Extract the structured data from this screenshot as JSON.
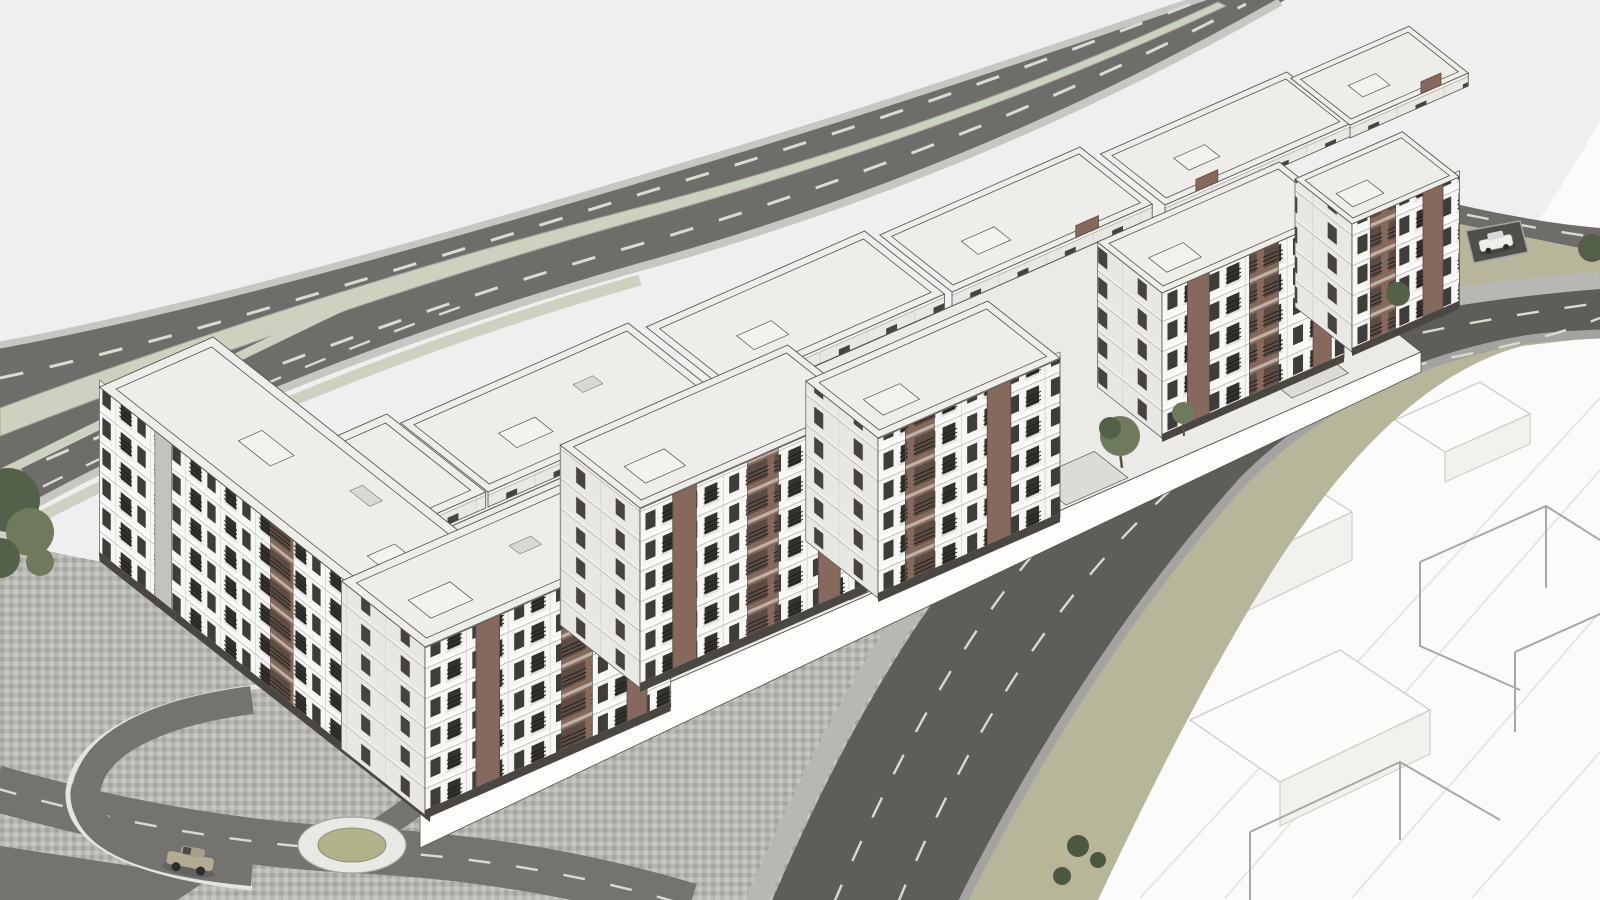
{
  "meta": {
    "title": "Aerial 3D architectural massing render of a residential apartment complex",
    "style": "monochrome SketchUp-style visualization, no text or UI elements visible",
    "canvas": {
      "width": 1600,
      "height": 900
    }
  },
  "colors": {
    "sky": "#f0eff0",
    "ghost": "#fbfbfa",
    "seam": "#e6e6e3",
    "wireframe": "#a8a8a5",
    "ghostBoxTop": "#fcfcfb",
    "ghostBoxSide": "#f1f1ee",
    "ghostBoxEdge": "#cfcfcc",
    "asphaltHighway": "#6e6d69",
    "asphaltMain": "#5e5d5a",
    "rampRoad": "#747370",
    "laneMarking": "#dadad2",
    "medianSage": "#ccd1c0",
    "vergeKhaki": "#b7b69b",
    "cobbleLight": "#c6c6c2",
    "cobbleMid": "#b7b7b3",
    "cobbleDark": "#a3a39f",
    "parkingBay": "#4f4e4b",
    "wallLight": "#e5e4e1",
    "facadeWhite": "#f7f6f3",
    "facadeSeam": "#cfcdc8",
    "facadeShade": "#e8e7e3",
    "facadeShadeSlab": "#f1efec",
    "stringCourse": "#9b9894",
    "cornice": "#fdfdfb",
    "plinth": "#4a4742",
    "roofLight": "#eeede9",
    "podium": "#ebeae7",
    "courtyard": "#dcdbd6",
    "bulkhead": "#f3f2ef",
    "vent": "#d9d8d4",
    "edgeInk": "#56524d",
    "windowDark": "#3f3d39",
    "windowDeep": "#34322e",
    "windowShade": "#47443f",
    "railing": "#1d1c19",
    "balcSlab": "#e4e2de",
    "accentBrown": "#84695c",
    "accentBrownDark": "#5d4c43",
    "accentBrownLight": "#c0b1a6",
    "grayAccent": "#c3c2be",
    "ringWhite": "#e9e8e5",
    "roundCenter": "#b1b18a",
    "roundCenterEdge": "#8f8f74",
    "treeDark": "#55604a",
    "treeMid": "#6e7a5b",
    "shrub": "#4c5640",
    "carBeige": "#b3ab94",
    "carBeigeTop": "#a79f8a",
    "carWhite": "#ededeb",
    "carWhiteTop": "#d6d8d8",
    "carGlass": "#4a4a46",
    "carEdge": "#6f6a5e",
    "wheel": "#2e2d2a"
  },
  "scene": {
    "background": "plain light-gray backdrop",
    "objects": [
      {
        "name": "highway",
        "desc": "dual-carriageway road running diagonally along the upper-left, pale sage median, dashed lane markings, exit ramp peeling toward lower-left"
      },
      {
        "name": "building-complex",
        "desc": "long staggered perimeter block of 5-6 story white apartment buildings with brown stair/balcony accents, flat roofs, courtyards"
      },
      {
        "name": "foreground-road",
        "desc": "curving two-to-three lane street from bottom center to right edge with cobble sidewalks"
      },
      {
        "name": "branch-road",
        "desc": "short internal street joining the curving road at a T-junction"
      },
      {
        "name": "plaza",
        "desc": "cobblestone paved forecourt at lower-left with access road, ramp retaining wall and roundabout"
      },
      {
        "name": "roundabout",
        "desc": "white ring with olive green center island"
      },
      {
        "name": "ghost-parcels",
        "desc": "white unmodeled ground at right with wireframe massing outlines of future buildings"
      },
      {
        "name": "khaki-verge",
        "desc": "olive planted verge strips along the curving road"
      },
      {
        "name": "cars",
        "desc": "one beige sedan driving near the roundabout, one white car parked in bay near the top-right corner"
      },
      {
        "name": "trees",
        "desc": "dark olive trees at the left edge, along the street junction and on the verge"
      }
    ]
  }
}
